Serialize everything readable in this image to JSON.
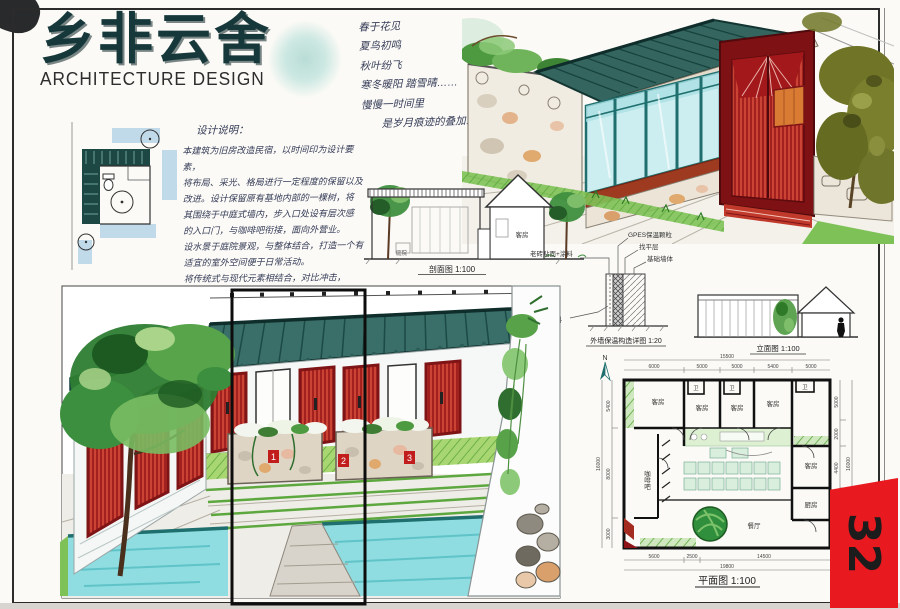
{
  "page": {
    "number": "32"
  },
  "title_block": {
    "title": "乡非云舍",
    "subtitle": "ARCHITECTURE DESIGN"
  },
  "poem": {
    "lines": [
      "春于花见",
      "夏鸟初鸣",
      "秋叶纷飞",
      "寒冬暖阳 踏雪晴……",
      "慢慢一时间里",
      "是岁月痕迹的叠加……"
    ]
  },
  "design_notes": {
    "heading": "设计说明：",
    "lines": [
      "本建筑为旧房改造民宿，以时间印为设计要素，",
      "将布局、采光、格局进行一定程度的保留以及",
      "改进。设计保留原有基地内部的一棵树，将",
      "其围绕于中庭式墙内，步入口处设有层次感",
      "的入口门，与咖啡吧衔接，面向外营业。",
      "设水景于庭院景观，与整体结合，打造一个有",
      "适宜的室外空间便于日常活动。",
      "将传统式与现代元素相结合，对比冲击，",
      "带来不一样的视觉与感受体验。"
    ]
  },
  "section_drawing": {
    "caption": "剖面图 1:100",
    "room_label": "客房",
    "yard_label": "庭院"
  },
  "wall_detail": {
    "caption": "外墙保温构造详图 1:20",
    "label_insulation": "GPES保温颗粒",
    "label_leveling": "找平层",
    "label_base_wall": "基础墙体",
    "label_finish": "老砖贴面+涂料",
    "label_material": "保温原料"
  },
  "elevation_drawing": {
    "caption": "立面图 1:100"
  },
  "floor_plan": {
    "caption": "平面图 1:100",
    "north_label": "N",
    "rooms": {
      "guest": "客房",
      "wc": "卫",
      "cafe": "咖啡吧",
      "dining": "餐厅",
      "kitchen": "厨房"
    },
    "dims": {
      "top_total": "15500",
      "top": [
        "6000",
        "5000",
        "5000",
        "5400",
        "5000"
      ],
      "bottom": [
        "5600",
        "2500",
        "14500"
      ],
      "bottom_total": "19800",
      "left": [
        "5400",
        "8000",
        "3000"
      ],
      "left_total": "16000",
      "right": [
        "5000",
        "2000",
        "4400"
      ],
      "right_total": "16000"
    }
  },
  "courtyard_view": {
    "tags": [
      "1",
      "2",
      "3"
    ]
  },
  "colors": {
    "title_teal": "#16383a",
    "roof_teal": "#35655f",
    "glass_blue": "#cdeef0",
    "door_red": "#b5221f",
    "tab_red": "#e8191f",
    "tree_green": "#2e7d32",
    "pool_cyan": "#8fdde0"
  }
}
